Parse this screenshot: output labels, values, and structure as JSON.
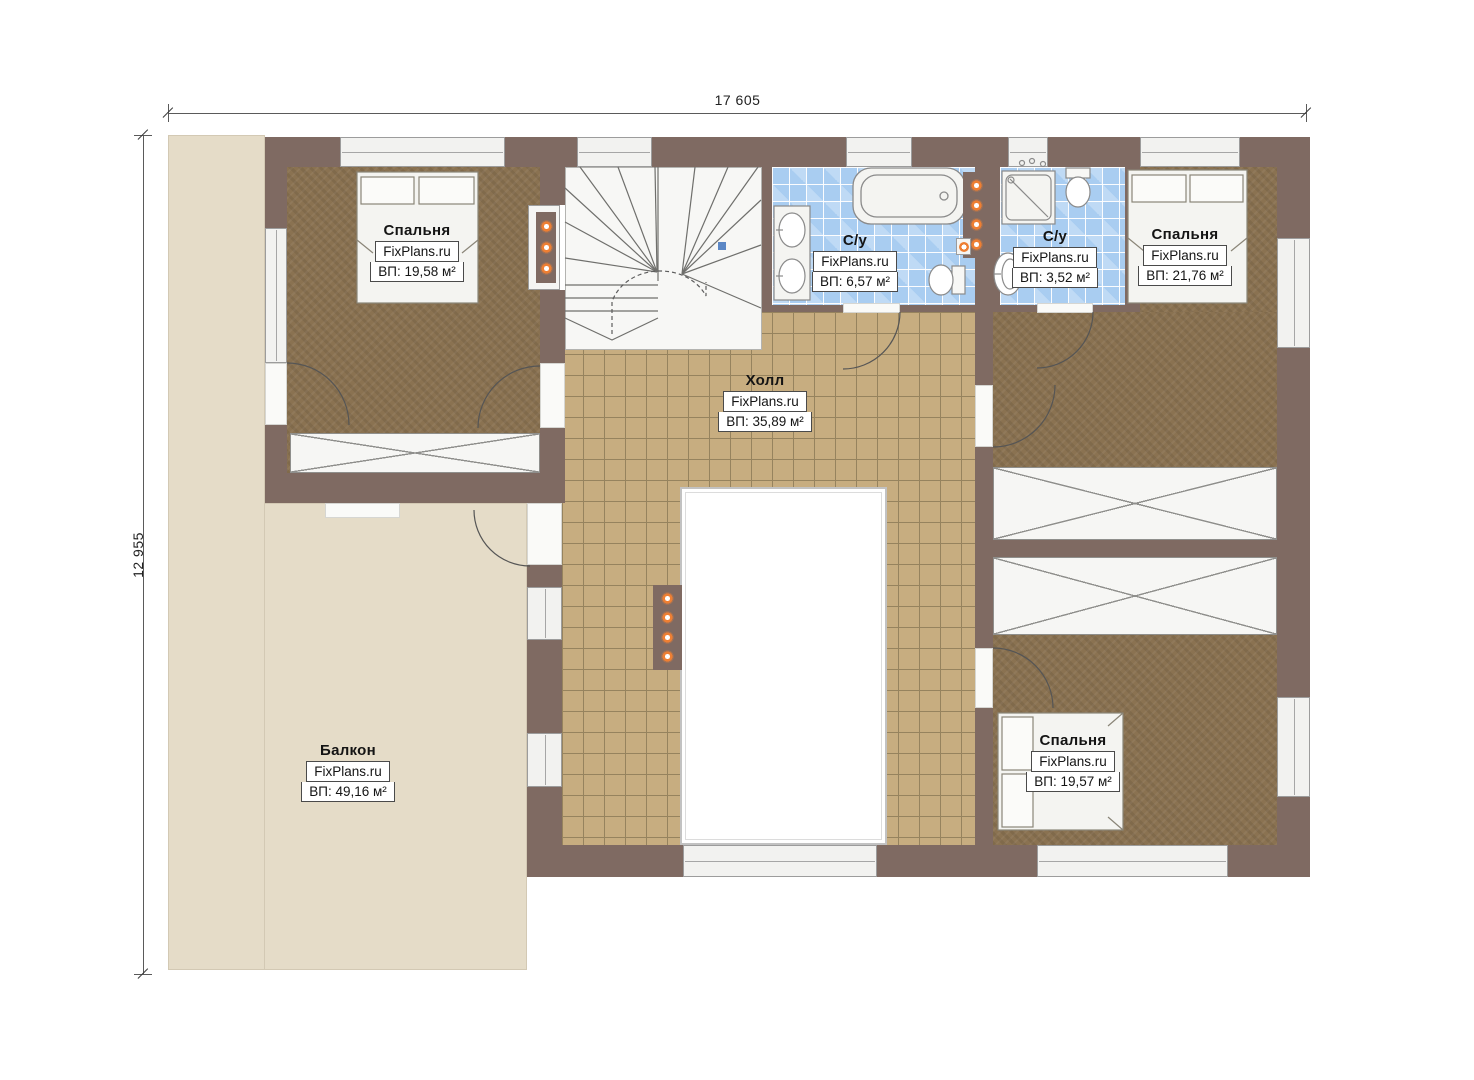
{
  "plan": {
    "type": "second-floor-plan",
    "dimensions": {
      "width_label": "17 605",
      "height_label": "12 955"
    },
    "watermark": "FixPlans.ru",
    "rooms": [
      {
        "id": "bedroom-top-left",
        "name": "Спальня",
        "watermark": "FixPlans.ru",
        "area": "ВП: 19,58 м²"
      },
      {
        "id": "bathroom-large",
        "name": "С/у",
        "watermark": "FixPlans.ru",
        "area": "ВП: 6,57 м²"
      },
      {
        "id": "bathroom-small",
        "name": "С/у",
        "watermark": "FixPlans.ru",
        "area": "ВП: 3,52 м²"
      },
      {
        "id": "bedroom-top-right",
        "name": "Спальня",
        "watermark": "FixPlans.ru",
        "area": "ВП: 21,76 м²"
      },
      {
        "id": "hall",
        "name": "Холл",
        "watermark": "FixPlans.ru",
        "area": "ВП: 35,89 м²"
      },
      {
        "id": "balcony",
        "name": "Балкон",
        "watermark": "FixPlans.ru",
        "area": "ВП: 49,16 м²"
      },
      {
        "id": "bedroom-bottom-right",
        "name": "Спальня",
        "watermark": "FixPlans.ru",
        "area": "ВП: 19,57 м²"
      }
    ],
    "colors": {
      "wall": "#7f6a62",
      "carpet": "#8a7251",
      "hall_tile": "#c7ad80",
      "bath_tile": "#a9cdf1",
      "balcony_floor": "#e5dcc8",
      "spotlight": "#ee7f33"
    }
  }
}
